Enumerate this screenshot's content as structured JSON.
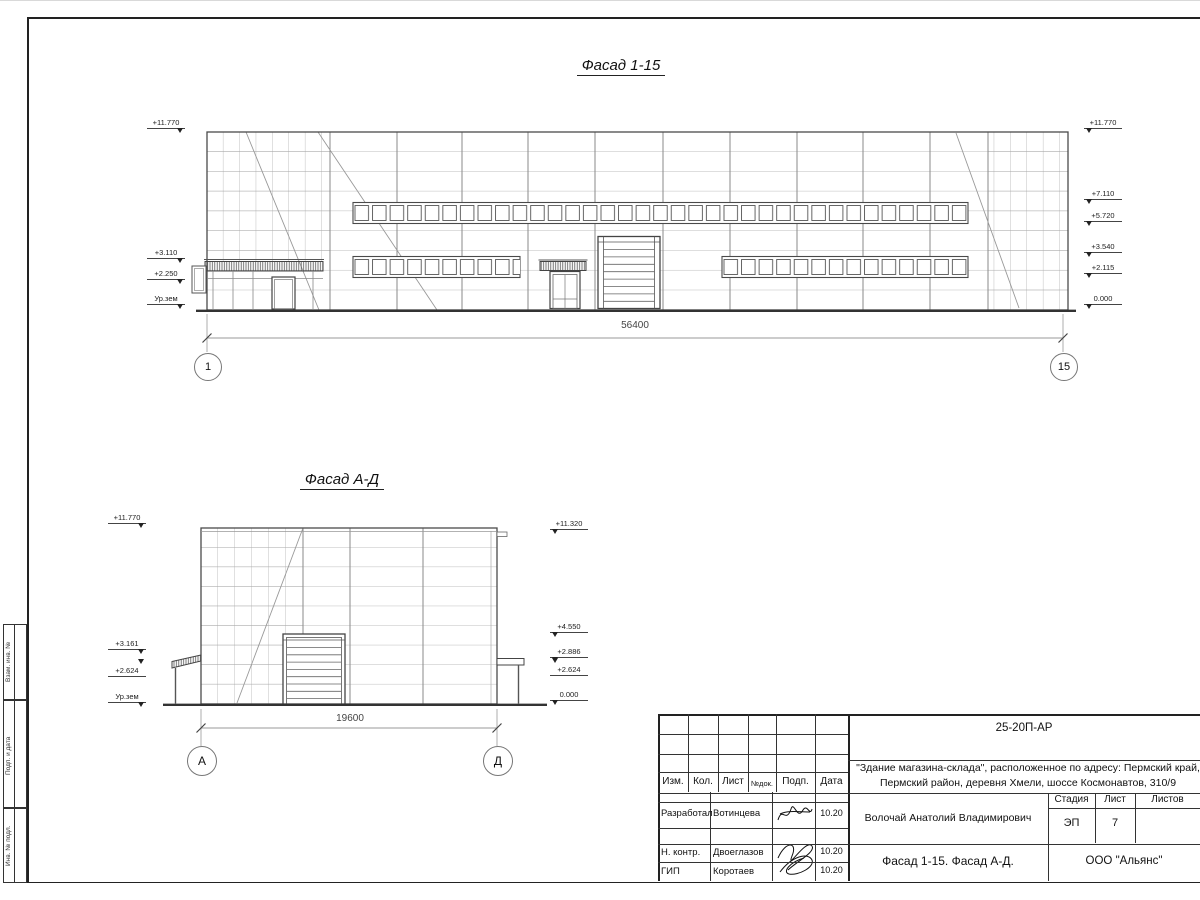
{
  "facade1": {
    "title": "Фасад 1-15",
    "dimension": "56400",
    "axis_left": "1",
    "axis_right": "15",
    "marks_left": [
      "+11.770",
      "+3.110",
      "+2.250",
      "Ур.зем"
    ],
    "marks_right": [
      "+11.770",
      "+7.110",
      "+5.720",
      "+3.540",
      "+2.115",
      "0.000"
    ]
  },
  "facade2": {
    "title": "Фасад А-Д",
    "dimension": "19600",
    "axis_left": "А",
    "axis_right": "Д",
    "marks_left": [
      "+11.770",
      "+3.161",
      "+2.624",
      "Ур.зем"
    ],
    "marks_right": [
      "+11.320",
      "+4.550",
      "+2.886",
      "+2.624",
      "0.000"
    ]
  },
  "titleblock": {
    "doc_number": "25-20П-АР",
    "project_line1": "\"Здание магазина-склада\", расположенное по адресу: Пермский край,",
    "project_line2": "Пермский район, деревня Хмели, шоссе Космонавтов, 310/9",
    "header": {
      "izm": "Изм.",
      "kol": "Кол.",
      "list": "Лист",
      "ndok": "№док.",
      "podp": "Подп.",
      "data": "Дата"
    },
    "rows": [
      {
        "role": "Разработал",
        "name": "Вотинцева",
        "date": "10.20"
      },
      {
        "role": "Н. контр.",
        "name": "Двоеглазов",
        "date": "10.20"
      },
      {
        "role": "ГИП",
        "name": "Коротаев",
        "date": "10.20"
      }
    ],
    "chief_name": "Волочай Анатолий Владимирович",
    "sheet_title": "Фасад 1-15. Фасад А-Д.",
    "company": "ООО \"Альянс\"",
    "stage_label": "Стадия",
    "sheet_label": "Лист",
    "sheets_label": "Листов",
    "stage_value": "ЭП",
    "sheet_value": "7"
  },
  "side_strip": {
    "labels": [
      "Взам. инв. №",
      "Подп. и дата",
      "Инв. № подл."
    ]
  },
  "colors": {
    "line_dark": "#444444",
    "line_light": "#a0a0a0",
    "dim_gray": "#999999",
    "ground": "#333333"
  }
}
